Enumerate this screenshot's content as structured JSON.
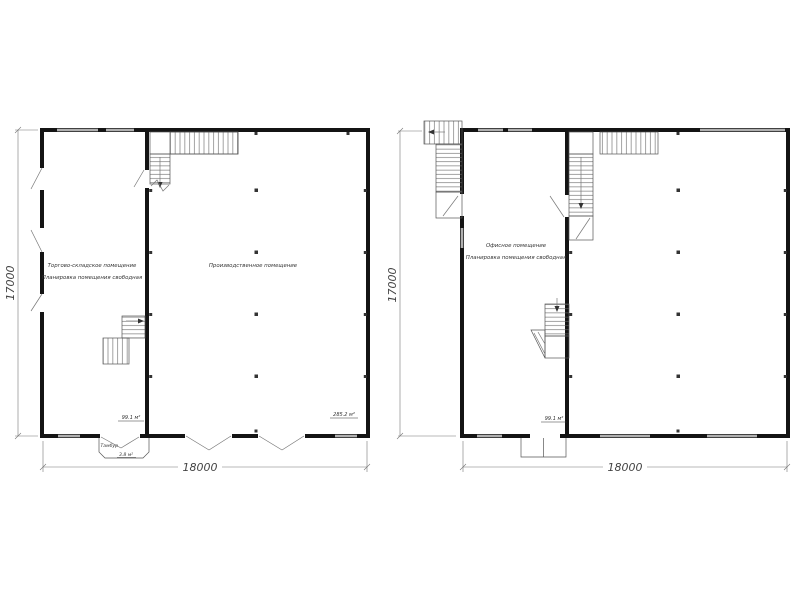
{
  "plans": [
    {
      "name": "warehouse-production-floor-plan",
      "rooms": [
        {
          "label_line1": "Торгово-складское помещение",
          "label_line2": "Планировка помещения свободная",
          "area": "99.1 м²"
        },
        {
          "label_line1": "Производственное помещение",
          "area": "285.2 м²"
        }
      ],
      "vestibule": {
        "label": "Тамбур",
        "area": "3.8 м²"
      },
      "dimensions": {
        "width": "18000",
        "height": "17000"
      }
    },
    {
      "name": "office-floor-plan",
      "rooms": [
        {
          "label_line1": "Офисное помещение",
          "label_line2": "Планировка помещения свободная",
          "area": "99.1 м²"
        }
      ],
      "dimensions": {
        "width": "18000",
        "height": "17000"
      }
    }
  ],
  "colors": {
    "wall": "#141414",
    "window": "#b0b0b0",
    "thin_line": "#666666",
    "text": "#333333",
    "background": "#ffffff"
  }
}
